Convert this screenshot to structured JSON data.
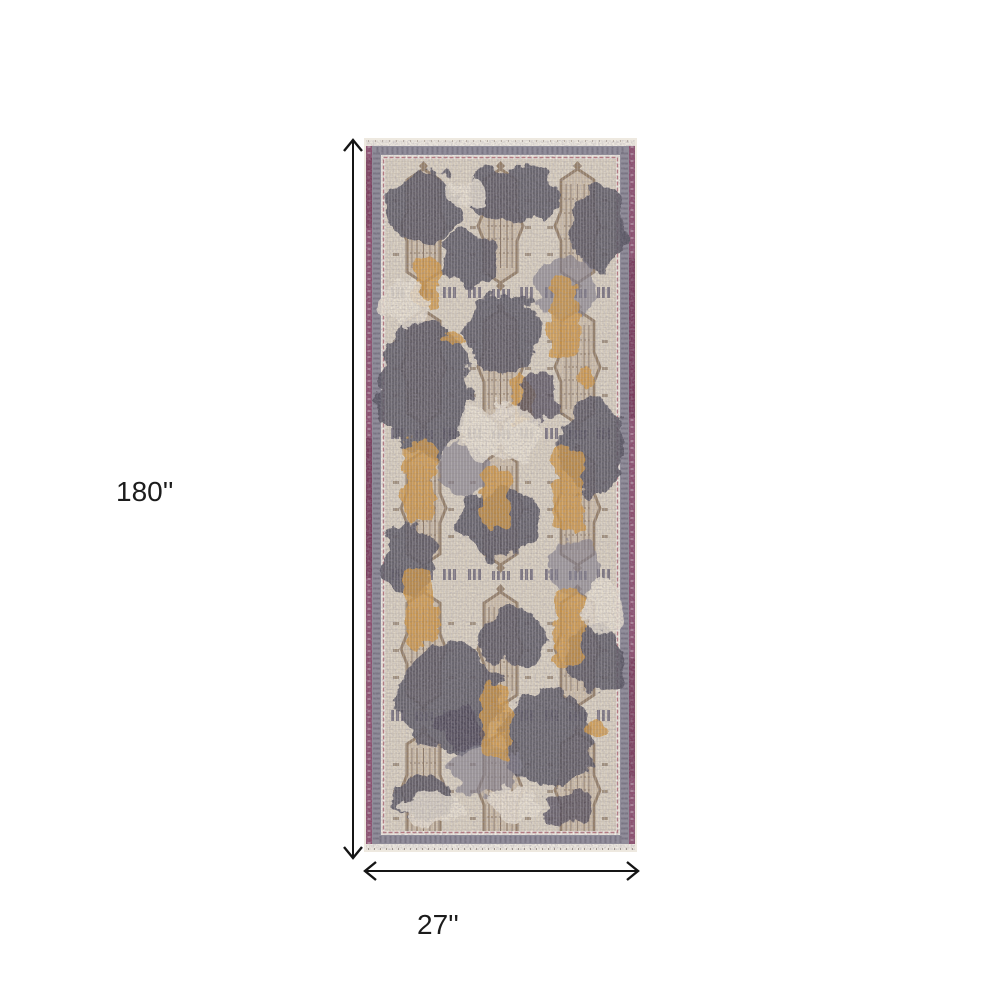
{
  "figure": {
    "type": "product-dimension-diagram",
    "height_label": "180''",
    "width_label": "27''"
  },
  "rug": {
    "description": "Distressed traditional runner rug with gray, taupe and gold medallion pattern on a cream field, plum side edges and gray ornamental border",
    "colors": {
      "outer_edge_cream": "#eee9e0",
      "edge_plum": "#8c4e6e",
      "edge_plum_dark": "#6d2f4e",
      "border_gray": "#8f8c99",
      "accent_red": "#a85b66",
      "field_cream": "#d9cfbf",
      "motif_taupe": "#b49d84",
      "motif_dark_gray": "#57525f",
      "motif_gold": "#d0953f",
      "arrow_black": "#151515"
    }
  }
}
